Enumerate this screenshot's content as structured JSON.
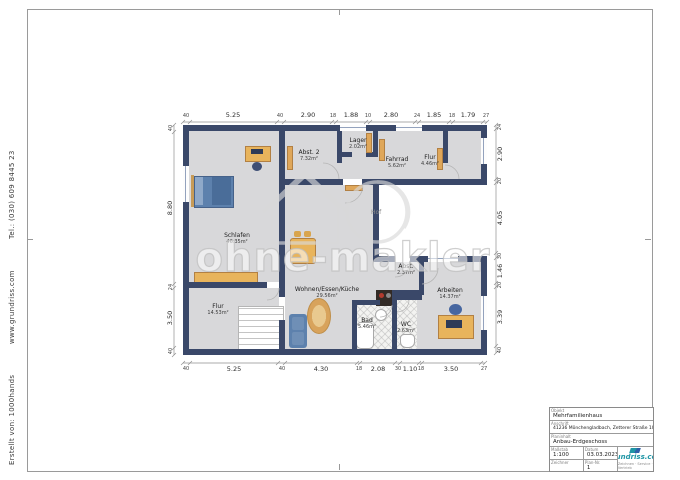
{
  "sheet": {
    "margin_credit": [
      "Erstellt von: 1000hands",
      "www.grundriss.com",
      "Tel.: (030) 609 8445 23"
    ]
  },
  "watermark": {
    "text": "ohne-makler"
  },
  "plan": {
    "outdoor_label": "Hof",
    "rooms": [
      {
        "name": "Schlafen",
        "area": "46.35m²"
      },
      {
        "name": "Flur",
        "area": "14.53m²"
      },
      {
        "name": "Abst. 2",
        "area": "7.32m²"
      },
      {
        "name": "Lager",
        "area": "2.02m²"
      },
      {
        "name": "Fahrrad",
        "area": "5.62m²"
      },
      {
        "name": "Flur",
        "area": "4.46m²"
      },
      {
        "name": "Wohnen/Essen/Küche",
        "area": "29.56m²"
      },
      {
        "name": "Abst.",
        "area": "2.37m²"
      },
      {
        "name": "Bad",
        "area": "5.46m²"
      },
      {
        "name": "WC",
        "area": "2.63m²"
      },
      {
        "name": "Arbeiten",
        "area": "14.37m²"
      }
    ],
    "dims": {
      "top": [
        "40",
        "5.25",
        "40",
        "2.90",
        "18",
        "1.88",
        "10",
        "2.80",
        "24",
        "1.85",
        "18",
        "1.79",
        "27"
      ],
      "bottom": [
        "40",
        "5.25",
        "40",
        "4.30",
        "18",
        "2.08",
        "30",
        "1.10",
        "18",
        "3.50",
        "27"
      ],
      "left": [
        "40",
        "8.80",
        "24",
        "3.50",
        "40"
      ],
      "right": [
        "24",
        "2.90",
        "20",
        "4.05",
        "30",
        "1.46",
        "20",
        "3.39",
        "40"
      ]
    }
  },
  "titleblock": {
    "objekt_label": "Objekt",
    "objekt": "Mehrfamilienhaus",
    "anschrift_label": "Anschrift",
    "anschrift": "41236 Mönchengladbach, Zetterer Straße 100",
    "planinhalt_label": "Planinhalt",
    "planinhalt": "Anbau-Erdgeschoss",
    "massstab_label": "Maßstab",
    "massstab": "1:100",
    "datum_label": "Datum",
    "datum": "03.03.2023",
    "zeichner_label": "Zeichner",
    "zeichner": "",
    "plannr_label": "Plan-Nr.",
    "plannr": "1",
    "logo_text": "grundriss.com",
    "logo_tagline": "Zeichnen · Service · Vertrieb"
  },
  "colors": {
    "wall": "#3a4869",
    "floor": "#d8d8da",
    "door_wood": "#dfa75a",
    "furniture_blue": "#5d81ad",
    "logo_teal": "#1f96a6"
  }
}
